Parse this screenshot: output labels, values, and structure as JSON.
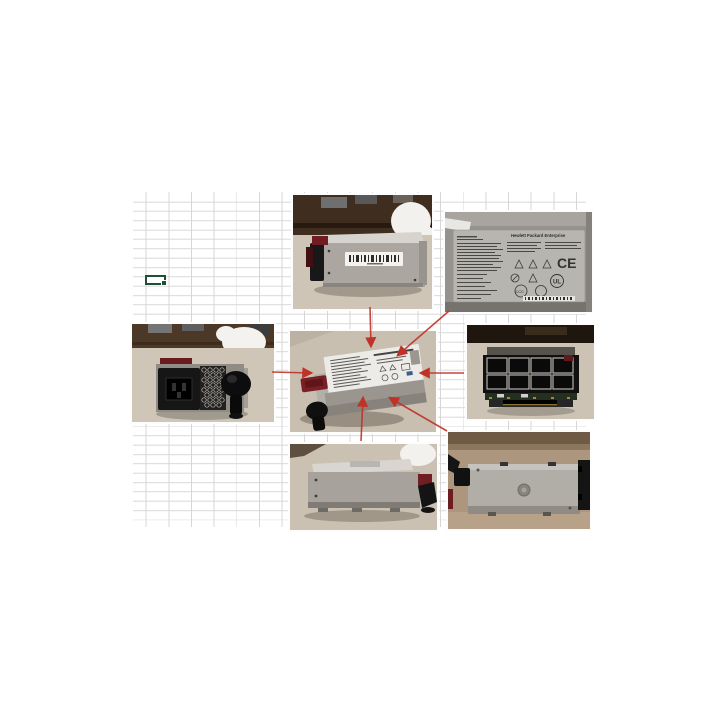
{
  "window": {
    "title": "Spreadsheet with power supply photo collage"
  },
  "colors": {
    "background": "#ffffff",
    "grid_line": "#d7d7d7",
    "selection_green": "#1e5038",
    "arrow_red": "#c03228",
    "counter_beige": "#cfc5b7",
    "wood_brown": "#4a3423",
    "psu_silver": "#aba69f",
    "handle_red": "#6f1d22",
    "counter_tan": "#ad967e"
  },
  "label_closeup": {
    "brand": "Hewlett Packard Enterprise",
    "marks": {
      "ce": "CE",
      "ul": "UL",
      "ccc": "CCC"
    }
  },
  "photos": {
    "top_side": {
      "alt": "side view with barcode label"
    },
    "label_closeup": {
      "alt": "regulatory label close-up"
    },
    "rear_view": {
      "alt": "rear view with AC inlet and handle"
    },
    "center_angle": {
      "alt": "angled overview with callouts"
    },
    "front_view": {
      "alt": "front grille and card-edge connector"
    },
    "bottom_side": {
      "alt": "opposite side view"
    },
    "bottom_flat": {
      "alt": "flat top/bottom view"
    }
  }
}
